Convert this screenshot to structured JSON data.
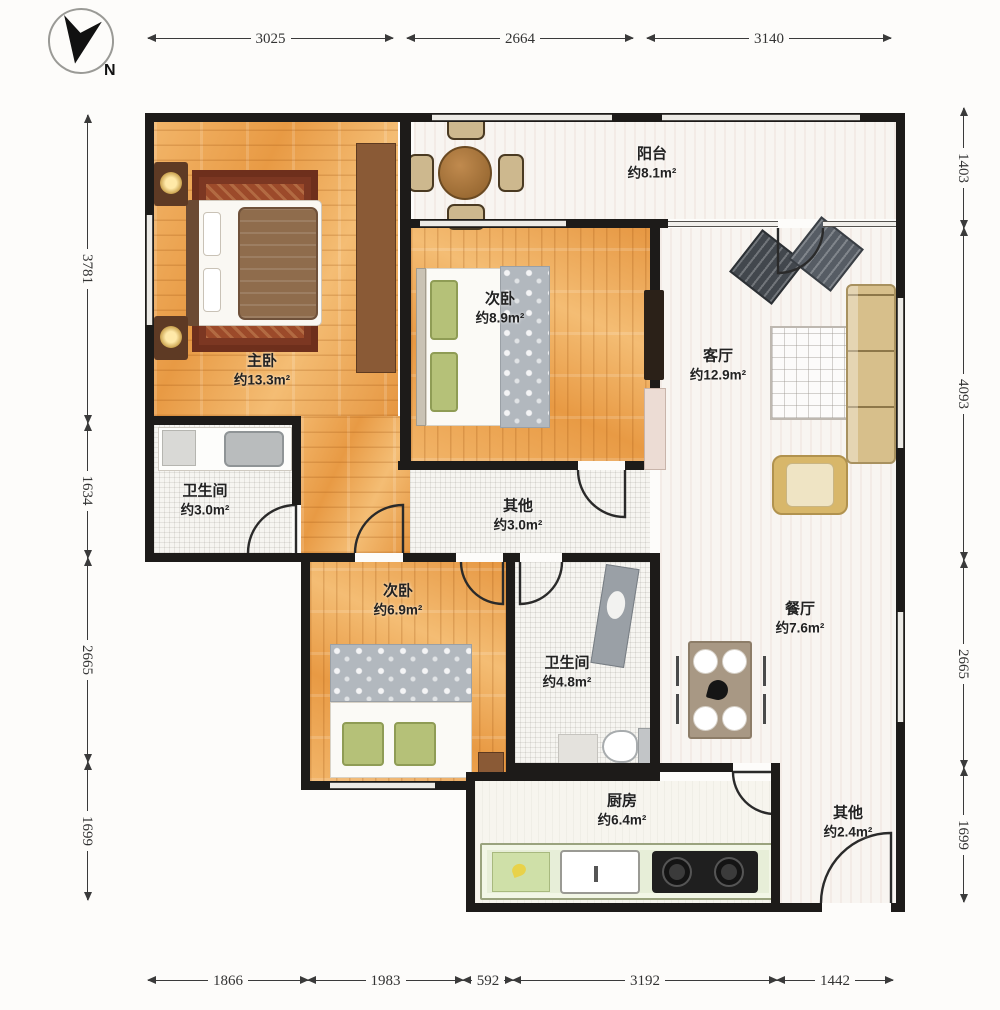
{
  "compass": {
    "label": "N"
  },
  "dimensions": {
    "top": [
      "3025",
      "2664",
      "3140"
    ],
    "bottom": [
      "1866",
      "1983",
      "592",
      "3192",
      "1442"
    ],
    "left": [
      "3781",
      "1634",
      "2665",
      "1699"
    ],
    "right": [
      "1403",
      "4093",
      "2665",
      "1699"
    ]
  },
  "rooms": [
    {
      "id": "balcony",
      "name": "阳台",
      "area": "约8.1m²"
    },
    {
      "id": "master",
      "name": "主卧",
      "area": "约13.3m²"
    },
    {
      "id": "bedroom2",
      "name": "次卧",
      "area": "约8.9m²"
    },
    {
      "id": "living",
      "name": "客厅",
      "area": "约12.9m²"
    },
    {
      "id": "bath1",
      "name": "卫生间",
      "area": "约3.0m²"
    },
    {
      "id": "other1",
      "name": "其他",
      "area": "约3.0m²"
    },
    {
      "id": "bedroom3",
      "name": "次卧",
      "area": "约6.9m²"
    },
    {
      "id": "bath2",
      "name": "卫生间",
      "area": "约4.8m²"
    },
    {
      "id": "dining",
      "name": "餐厅",
      "area": "约7.6m²"
    },
    {
      "id": "kitchen",
      "name": "厨房",
      "area": "约6.4m²"
    },
    {
      "id": "other2",
      "name": "其他",
      "area": "约2.4m²"
    }
  ],
  "colors": {
    "wall": "#1d1b19",
    "wood_floor": "#ea9f4b",
    "light_floor": "#f8f5f1",
    "rug_master": "#8a3e23",
    "sofa": "#d7bf8b",
    "counter": "#e7eed8",
    "cooktop": "#1f1f1f",
    "green_pillow": "#b5c178"
  }
}
